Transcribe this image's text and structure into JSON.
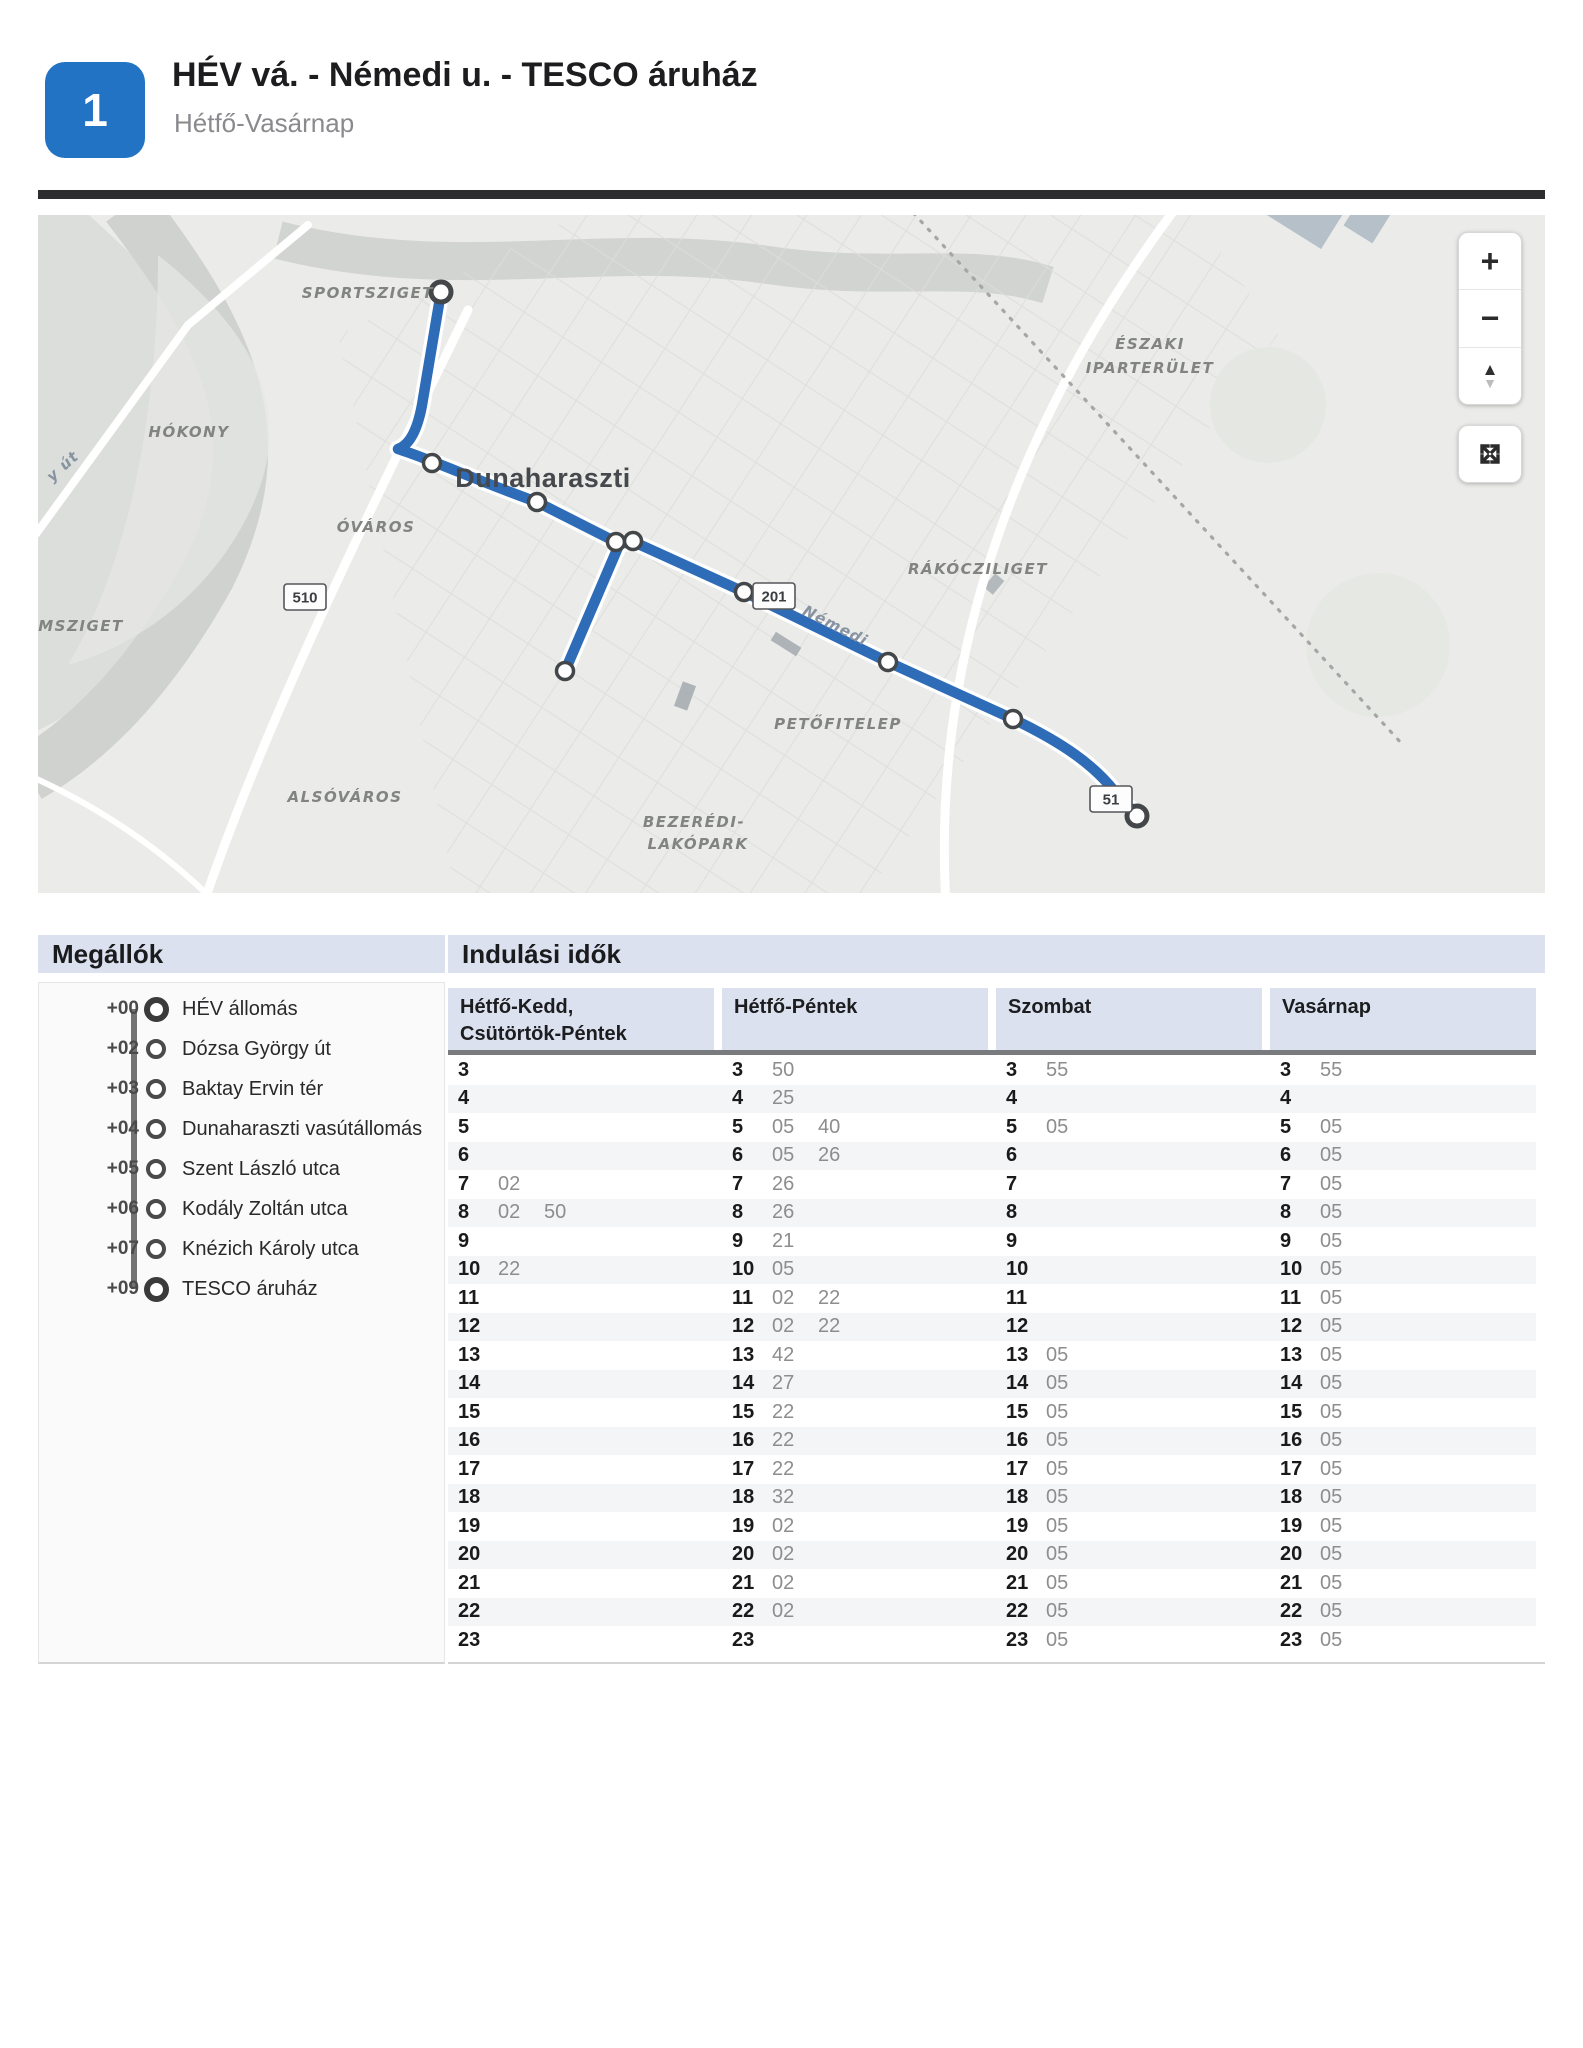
{
  "header": {
    "route_number": "1",
    "title": "HÉV vá. - Némedi u. - TESCO áruház",
    "subtitle": "Hétfő-Vasárnap"
  },
  "map": {
    "area_labels": [
      {
        "text": "SPORTSZIGET",
        "x": 396,
        "y": 83,
        "anchor": "end"
      },
      {
        "text": "HÓKONY",
        "x": 151,
        "y": 222,
        "anchor": "middle"
      },
      {
        "text": "ÓVÁROS",
        "x": 338,
        "y": 317,
        "anchor": "middle"
      },
      {
        "text": "OMSZIGET",
        "x": -14,
        "y": 416,
        "anchor": "start"
      },
      {
        "text": "ALSÓVÁROS",
        "x": 307,
        "y": 587,
        "anchor": "middle"
      },
      {
        "text": "BEZERÉDI-",
        "x": 656,
        "y": 612,
        "anchor": "middle"
      },
      {
        "text": "LAKÓPARK",
        "x": 660,
        "y": 634,
        "anchor": "middle"
      },
      {
        "text": "PETŐFITELEP",
        "x": 800,
        "y": 514,
        "anchor": "middle"
      },
      {
        "text": "RÁKÓCZILIGET",
        "x": 940,
        "y": 359,
        "anchor": "middle"
      },
      {
        "text": "ÉSZAKI",
        "x": 1112,
        "y": 134,
        "anchor": "middle"
      },
      {
        "text": "IPARTERÜLET",
        "x": 1112,
        "y": 158,
        "anchor": "middle"
      }
    ],
    "town_label": {
      "text": "Dunaharaszti",
      "x": 505,
      "y": 272
    },
    "street_labels": [
      {
        "text": "y út",
        "x": 28,
        "y": 255,
        "rotate": -42
      },
      {
        "text": "Némedi",
        "x": 795,
        "y": 415,
        "rotate": 27
      }
    ],
    "road_badges": [
      {
        "text": "510",
        "x": 267,
        "y": 382
      },
      {
        "text": "201",
        "x": 736,
        "y": 381
      },
      {
        "text": "51",
        "x": 1073,
        "y": 584
      }
    ],
    "controls": {
      "zoom_in": "+",
      "zoom_out": "−",
      "tilt_up": "▲",
      "tilt_down": "▼"
    },
    "route_color": "#2e6cb7"
  },
  "stops_section": {
    "title": "Megállók",
    "stops": [
      {
        "offset": "+00",
        "name": "HÉV állomás",
        "terminal": true
      },
      {
        "offset": "+02",
        "name": "Dózsa György út",
        "terminal": false
      },
      {
        "offset": "+03",
        "name": "Baktay Ervin tér",
        "terminal": false
      },
      {
        "offset": "+04",
        "name": "Dunaharaszti vasútállomás",
        "terminal": false
      },
      {
        "offset": "+05",
        "name": "Szent László utca",
        "terminal": false
      },
      {
        "offset": "+06",
        "name": "Kodály Zoltán utca",
        "terminal": false
      },
      {
        "offset": "+07",
        "name": "Knézich Károly utca",
        "terminal": false
      },
      {
        "offset": "+09",
        "name": "TESCO áruház",
        "terminal": true
      }
    ]
  },
  "times_section": {
    "title": "Indulási idők",
    "columns": [
      {
        "lines": [
          "Hétfő-Kedd,",
          "Csütörtök-Péntek"
        ]
      },
      {
        "lines": [
          "Hétfő-Péntek"
        ]
      },
      {
        "lines": [
          "Szombat"
        ]
      },
      {
        "lines": [
          "Vasárnap"
        ]
      }
    ],
    "rows": [
      {
        "hour": "3",
        "cols": [
          [],
          [
            "50"
          ],
          [
            "55"
          ],
          [
            "55"
          ]
        ]
      },
      {
        "hour": "4",
        "cols": [
          [],
          [
            "25"
          ],
          [],
          []
        ]
      },
      {
        "hour": "5",
        "cols": [
          [],
          [
            "05",
            "40"
          ],
          [
            "05"
          ],
          [
            "05"
          ]
        ]
      },
      {
        "hour": "6",
        "cols": [
          [],
          [
            "05",
            "26"
          ],
          [],
          [
            "05"
          ]
        ]
      },
      {
        "hour": "7",
        "cols": [
          [
            "02"
          ],
          [
            "26"
          ],
          [],
          [
            "05"
          ]
        ]
      },
      {
        "hour": "8",
        "cols": [
          [
            "02",
            "50"
          ],
          [
            "26"
          ],
          [],
          [
            "05"
          ]
        ]
      },
      {
        "hour": "9",
        "cols": [
          [],
          [
            "21"
          ],
          [],
          [
            "05"
          ]
        ]
      },
      {
        "hour": "10",
        "cols": [
          [
            "22"
          ],
          [
            "05"
          ],
          [],
          [
            "05"
          ]
        ]
      },
      {
        "hour": "11",
        "cols": [
          [],
          [
            "02",
            "22"
          ],
          [],
          [
            "05"
          ]
        ]
      },
      {
        "hour": "12",
        "cols": [
          [],
          [
            "02",
            "22"
          ],
          [],
          [
            "05"
          ]
        ]
      },
      {
        "hour": "13",
        "cols": [
          [],
          [
            "42"
          ],
          [
            "05"
          ],
          [
            "05"
          ]
        ]
      },
      {
        "hour": "14",
        "cols": [
          [],
          [
            "27"
          ],
          [
            "05"
          ],
          [
            "05"
          ]
        ]
      },
      {
        "hour": "15",
        "cols": [
          [],
          [
            "22"
          ],
          [
            "05"
          ],
          [
            "05"
          ]
        ]
      },
      {
        "hour": "16",
        "cols": [
          [],
          [
            "22"
          ],
          [
            "05"
          ],
          [
            "05"
          ]
        ]
      },
      {
        "hour": "17",
        "cols": [
          [],
          [
            "22"
          ],
          [
            "05"
          ],
          [
            "05"
          ]
        ]
      },
      {
        "hour": "18",
        "cols": [
          [],
          [
            "32"
          ],
          [
            "05"
          ],
          [
            "05"
          ]
        ]
      },
      {
        "hour": "19",
        "cols": [
          [],
          [
            "02"
          ],
          [
            "05"
          ],
          [
            "05"
          ]
        ]
      },
      {
        "hour": "20",
        "cols": [
          [],
          [
            "02"
          ],
          [
            "05"
          ],
          [
            "05"
          ]
        ]
      },
      {
        "hour": "21",
        "cols": [
          [],
          [
            "02"
          ],
          [
            "05"
          ],
          [
            "05"
          ]
        ]
      },
      {
        "hour": "22",
        "cols": [
          [],
          [
            "02"
          ],
          [
            "05"
          ],
          [
            "05"
          ]
        ]
      },
      {
        "hour": "23",
        "cols": [
          [],
          [],
          [
            "05"
          ],
          [
            "05"
          ]
        ]
      }
    ]
  }
}
